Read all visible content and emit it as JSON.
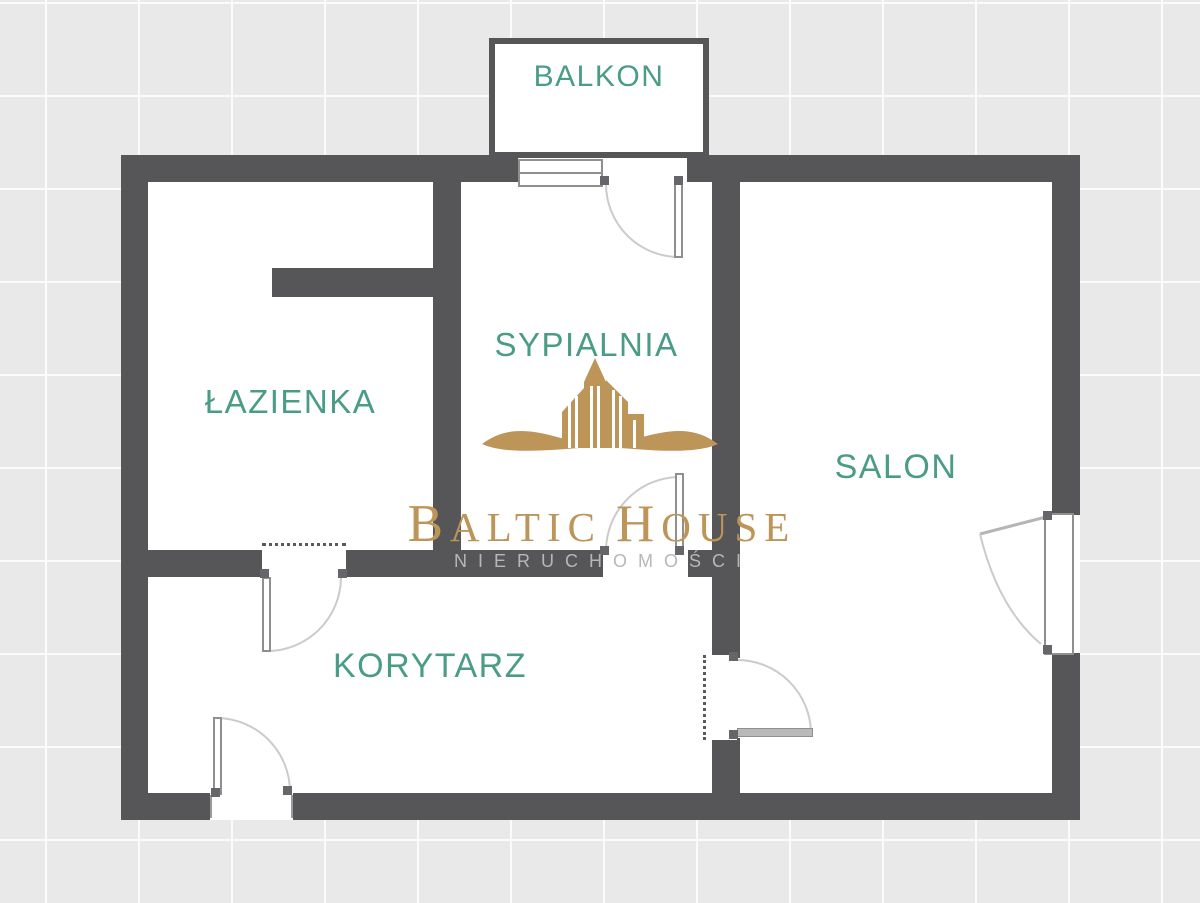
{
  "plan_title": "Apartment floor plan",
  "rooms": [
    {
      "id": "balkon",
      "label": "BALKON"
    },
    {
      "id": "lazienka",
      "label": "ŁAZIENKA"
    },
    {
      "id": "sypialnia",
      "label": "SYPIALNIA"
    },
    {
      "id": "salon",
      "label": "SALON"
    },
    {
      "id": "korytarz",
      "label": "KORYTARZ"
    }
  ],
  "watermark": {
    "word1_initial": "B",
    "word1_rest": "ALTIC",
    "word2_initial": "H",
    "word2_rest": "OUSE",
    "subtitle": "NIERUCHOMOŚCI"
  },
  "colors": {
    "wall": "#565659",
    "room_label": "#4a9c87",
    "brand_gold": "#bd9559",
    "brand_subtitle_gray": "#b7b7b7",
    "tile_background": "#e9e9e9",
    "tile_grout": "#fbfbfb",
    "door_arc": "#cbcbcb"
  }
}
